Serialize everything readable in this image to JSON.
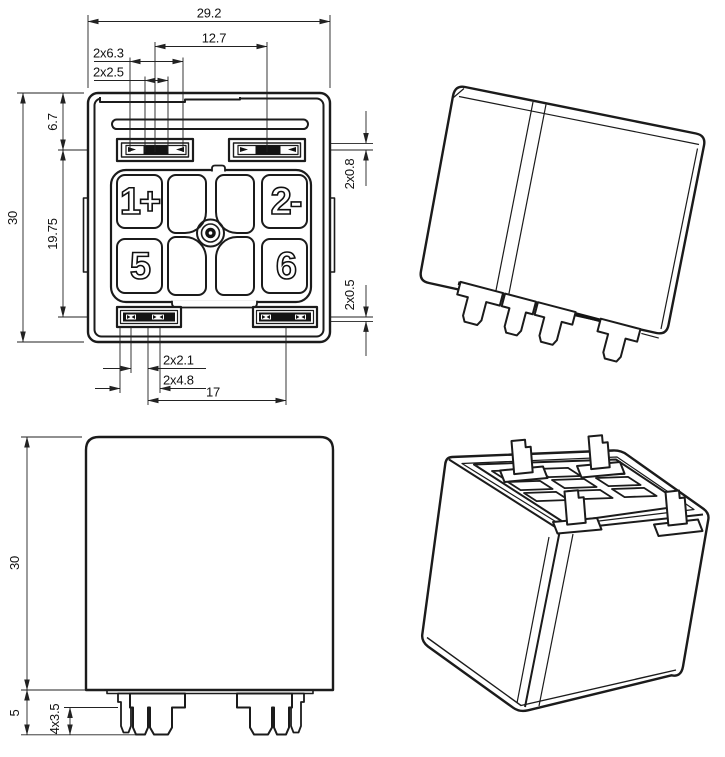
{
  "page": {
    "background": "#ffffff",
    "line_color": "#1b1b1b"
  },
  "top_view": {
    "dims": {
      "overall_width": "29.2",
      "terminal_pitch": "12.7",
      "slot_width": "2x6.3",
      "slot_opening": "2x2.5",
      "top_offset": "6.7",
      "overall_height": "30",
      "row_pitch": "19.75",
      "blade_top": "2x0.8",
      "blade_bottom": "2x0.5",
      "tab_small": "2x2.1",
      "tab_large": "2x4.8",
      "bottom_terminal_pitch": "17"
    },
    "pads": [
      "1+",
      "2-",
      "5",
      "6"
    ]
  },
  "front_view": {
    "dims": {
      "body_height": "30",
      "standoff_height": "5",
      "pin_length": "4x3.5"
    }
  }
}
